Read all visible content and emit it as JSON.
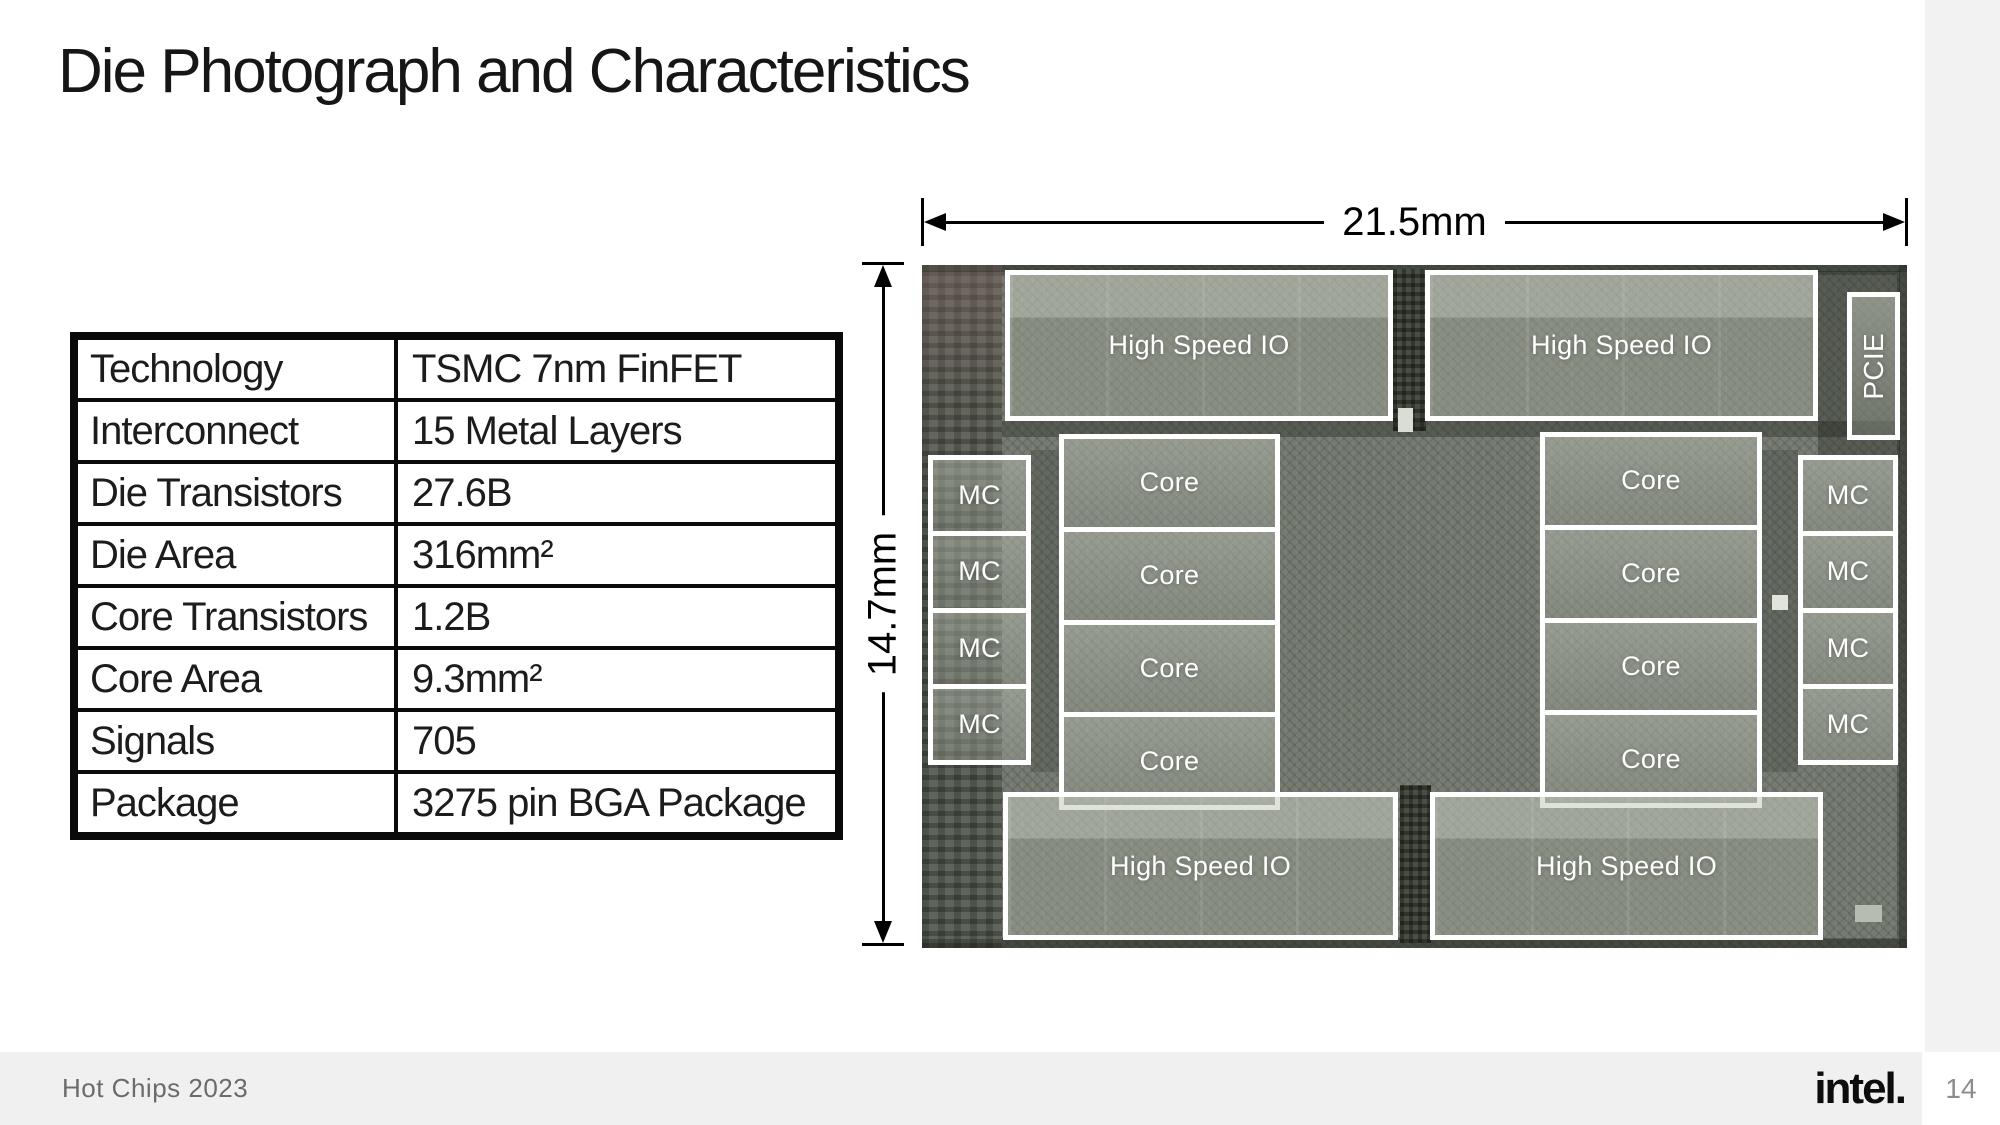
{
  "slide": {
    "title": "Die Photograph and Characteristics"
  },
  "table": {
    "rows": [
      {
        "label": "Technology",
        "value": "TSMC 7nm FinFET"
      },
      {
        "label": "Interconnect",
        "value": "15 Metal Layers"
      },
      {
        "label": "Die Transistors",
        "value": "27.6B"
      },
      {
        "label": "Die Area",
        "value": "316mm²"
      },
      {
        "label": "Core Transistors",
        "value": "1.2B"
      },
      {
        "label": "Core Area",
        "value": "9.3mm²"
      },
      {
        "label": "Signals",
        "value": "705"
      },
      {
        "label": "Package",
        "value": "3275 pin BGA Package"
      }
    ]
  },
  "die": {
    "width_label": "21.5mm",
    "height_label": "14.7mm",
    "labels": {
      "hsio": "High Speed IO",
      "core": "Core",
      "mc": "MC",
      "pcie": "PCIE"
    }
  },
  "footer": {
    "left_text": "Hot Chips 2023",
    "brand": "intel.",
    "page_number": "14"
  },
  "colors": {
    "footer_band": "#f0f0f0",
    "right_strip": "#f2f2f2",
    "die_base": "#767c72",
    "overlay_border": "#ffffff",
    "text": "#1a1a1a"
  }
}
